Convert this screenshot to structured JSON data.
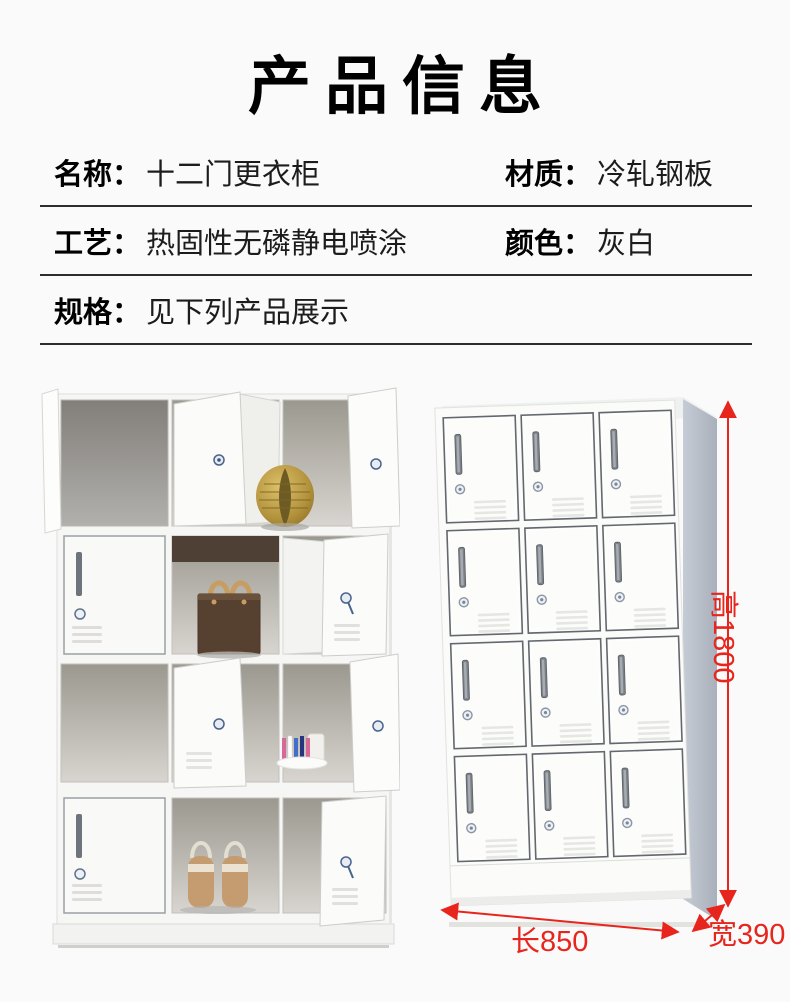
{
  "page": {
    "title": "产品信息"
  },
  "specs": {
    "rows": [
      {
        "left_label": "名称：",
        "left_value": "十二门更衣柜",
        "right_label": "材质：",
        "right_value": "冷轧钢板"
      },
      {
        "left_label": "工艺：",
        "left_value": "热固性无磷静电喷涂",
        "right_label": "颜色：",
        "right_value": "灰白"
      },
      {
        "left_label": "规格：",
        "left_value": "见下列产品展示"
      }
    ]
  },
  "annotations": {
    "height": "高1800",
    "length": "长850",
    "width": "宽390"
  },
  "colors": {
    "accent_red": "#e8251c",
    "text": "#111111",
    "divider": "#2d2d2d",
    "cabinet_side_gray": "#aeb5c0"
  }
}
